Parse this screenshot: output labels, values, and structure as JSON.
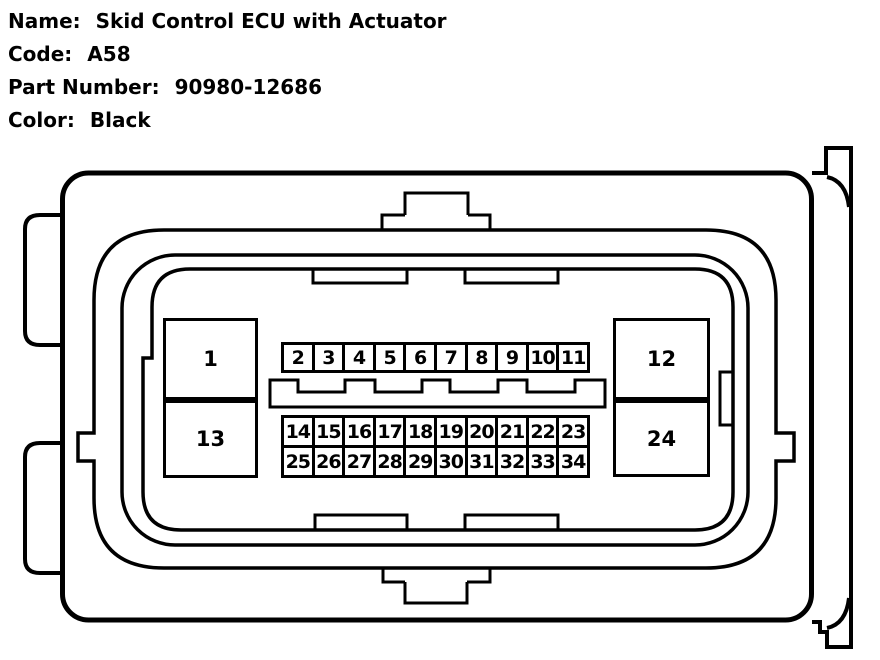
{
  "header": {
    "rows": [
      {
        "label": "Name:",
        "value": "Skid Control ECU with Actuator"
      },
      {
        "label": "Code:",
        "value": "A58"
      },
      {
        "label": "Part Number:",
        "value": "90980-12686"
      },
      {
        "label": "Color:",
        "value": "Black"
      }
    ]
  },
  "connector": {
    "large_pins": {
      "pin1": "1",
      "pin12": "12",
      "pin13": "13",
      "pin24": "24"
    },
    "pin_row_top": [
      "2",
      "3",
      "4",
      "5",
      "6",
      "7",
      "8",
      "9",
      "10",
      "11"
    ],
    "pin_row_middle": [
      "14",
      "15",
      "16",
      "17",
      "18",
      "19",
      "20",
      "21",
      "22",
      "23"
    ],
    "pin_row_bottom": [
      "25",
      "26",
      "27",
      "28",
      "29",
      "30",
      "31",
      "32",
      "33",
      "34"
    ],
    "colors": {
      "line": "#000000",
      "background": "#ffffff"
    }
  }
}
